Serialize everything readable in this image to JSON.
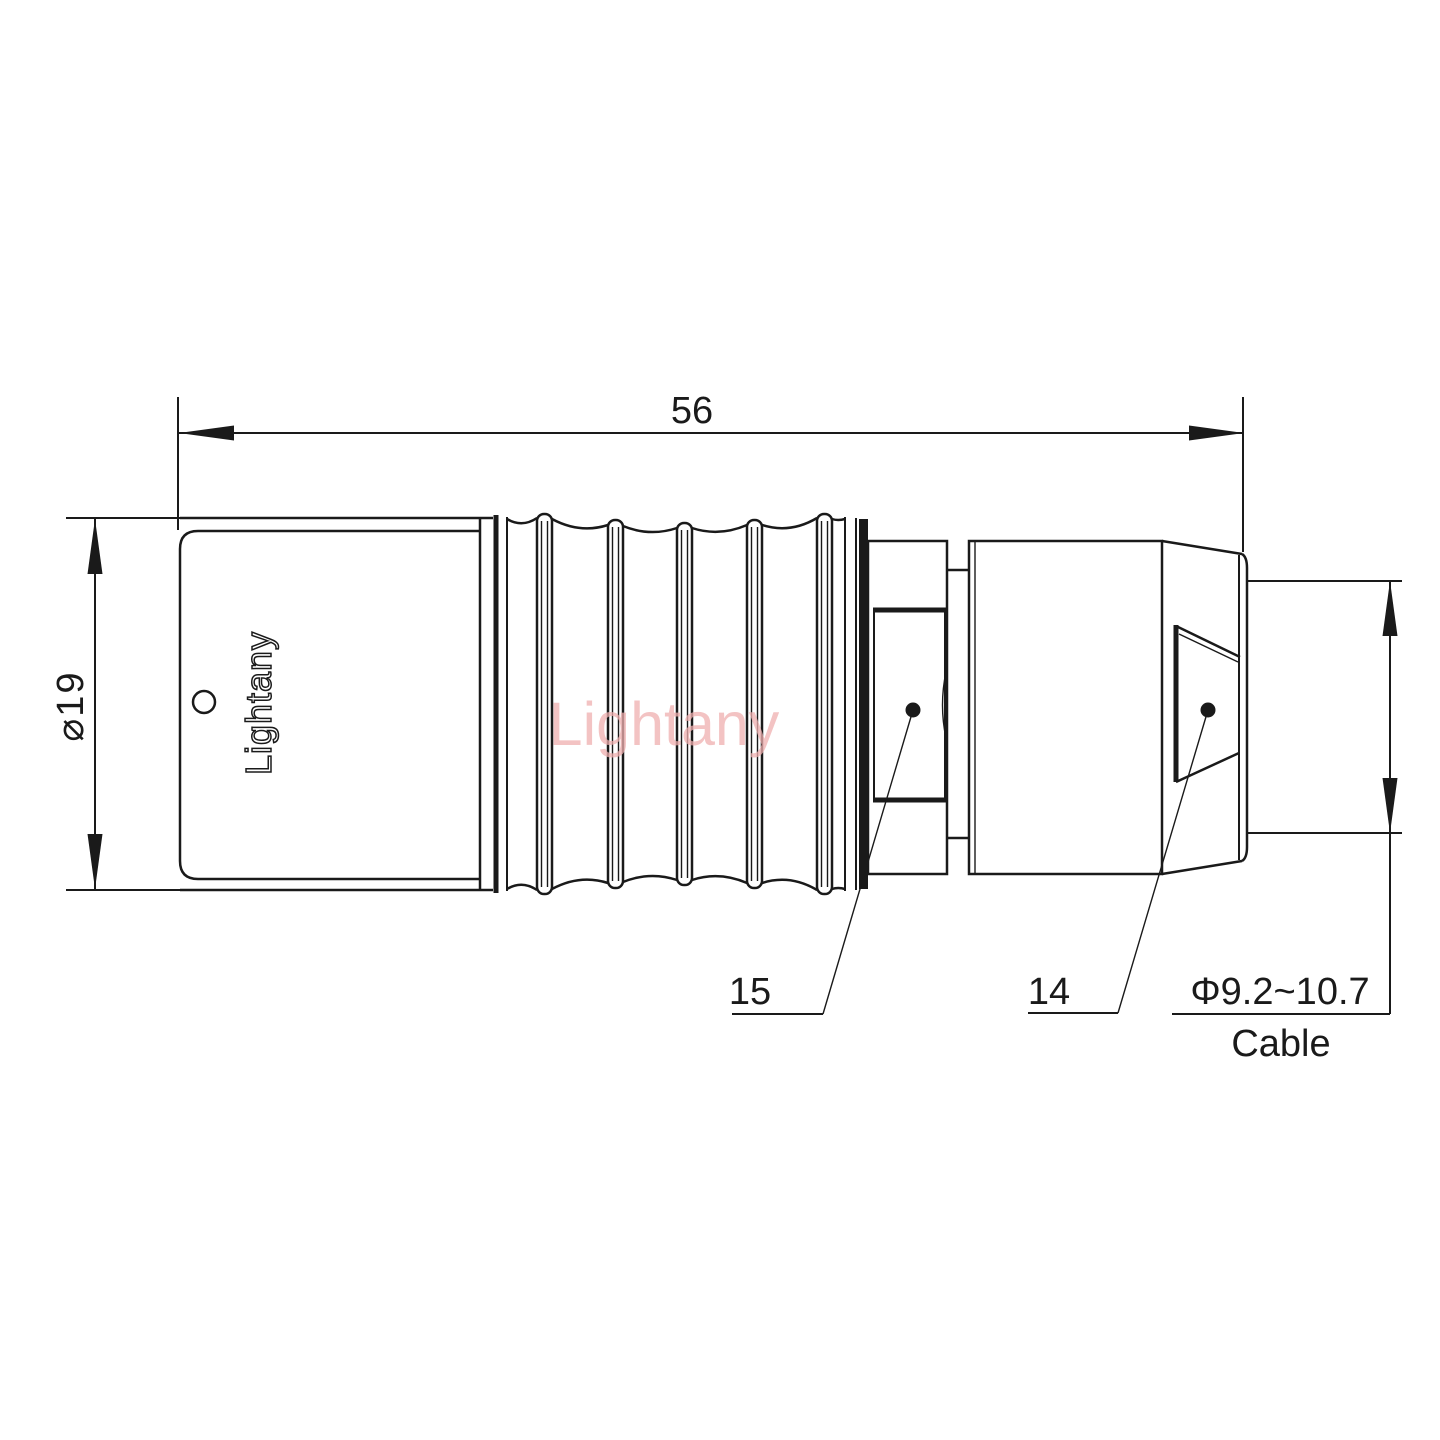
{
  "drawing": {
    "title": "connector-technical-drawing",
    "dimensions": {
      "overall_length": "56",
      "body_diameter": "⌀19",
      "cable_range": "Φ9.2~10.7",
      "cable_word": "Cable"
    },
    "part_labels": {
      "collet": "15",
      "nut": "14"
    },
    "brand": "Lightany",
    "watermark": "Lightany"
  },
  "colors": {
    "line": "#1a1a1a",
    "watermark_pink": "#f0b0b0",
    "background": "#ffffff"
  }
}
